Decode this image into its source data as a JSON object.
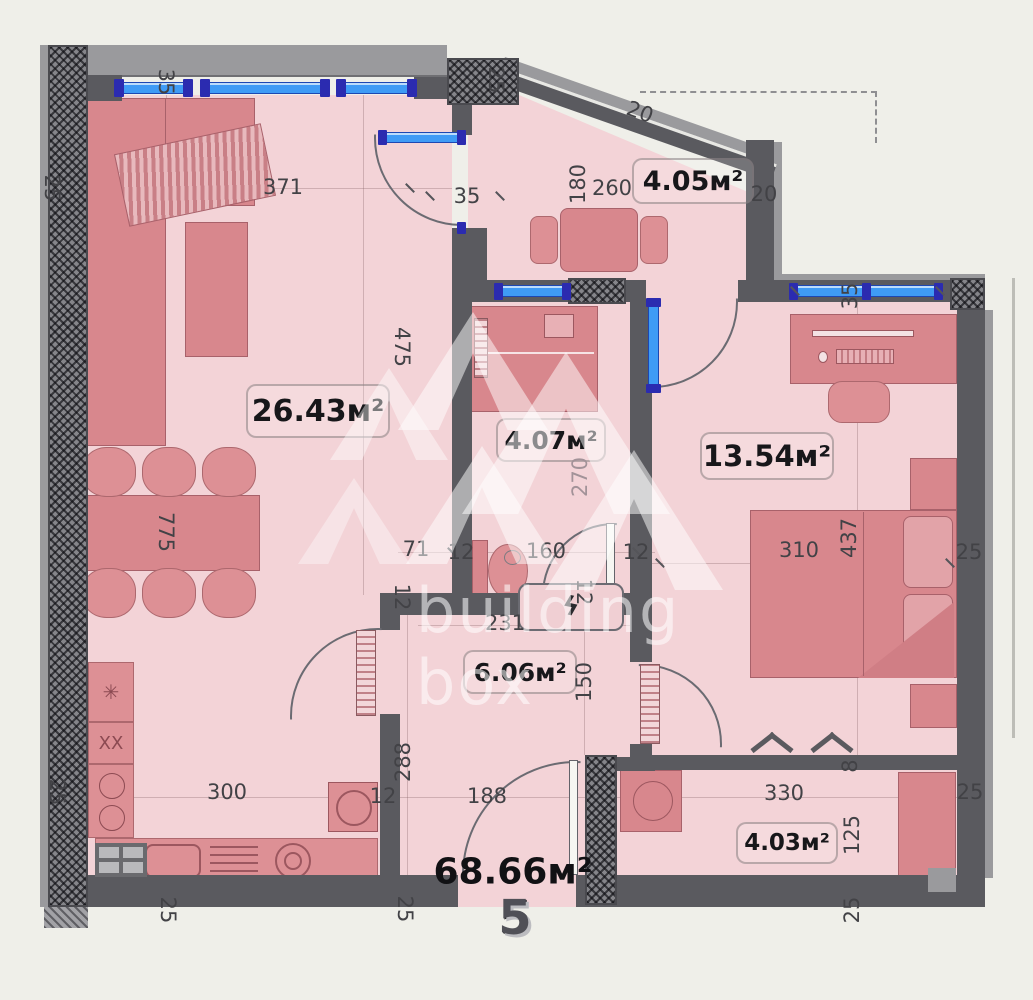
{
  "plan": {
    "apartment_number": "5",
    "total_area": "68.66м²",
    "watermark": {
      "line1": "building",
      "line2": "box",
      "logo": "chevron-pattern"
    },
    "rooms": {
      "living": {
        "area": "26.43м²"
      },
      "bathroom": {
        "area": "4.07м²"
      },
      "bedroom": {
        "area": "13.54м²"
      },
      "hallway": {
        "area": "6.06м²"
      },
      "balcony_top": {
        "area": "4.05м²"
      },
      "balcony_bottom": {
        "area": "4.03м²"
      }
    },
    "colors": {
      "background": "#efefe9",
      "room_fill": "#f3d3d7",
      "furniture": "#dd9095",
      "wall": "#5a5a5f",
      "window_glass": "#3f9bf5",
      "window_frame": "#2b2bb0",
      "watermark": "#ffffff"
    },
    "dimensions": [
      {
        "t": "371",
        "x": 283,
        "y": 187,
        "r": 0
      },
      {
        "t": "35",
        "x": 166,
        "y": 82,
        "r": 90
      },
      {
        "t": "25",
        "x": 52,
        "y": 188,
        "r": 90
      },
      {
        "t": "25",
        "x": 496,
        "y": 80,
        "r": 90
      },
      {
        "t": "35",
        "x": 467,
        "y": 196,
        "r": 0
      },
      {
        "t": "20",
        "x": 640,
        "y": 112,
        "r": 20
      },
      {
        "t": "180",
        "x": 578,
        "y": 184,
        "r": -90
      },
      {
        "t": "260",
        "x": 612,
        "y": 188,
        "r": 0
      },
      {
        "t": "20",
        "x": 764,
        "y": 194,
        "r": 0
      },
      {
        "t": "35",
        "x": 850,
        "y": 296,
        "r": -90
      },
      {
        "t": "475",
        "x": 402,
        "y": 347,
        "r": 90
      },
      {
        "t": "270",
        "x": 580,
        "y": 477,
        "r": -90,
        "c": "muted"
      },
      {
        "t": "71",
        "x": 416,
        "y": 549,
        "r": 0
      },
      {
        "t": "12",
        "x": 461,
        "y": 552,
        "r": 0
      },
      {
        "t": "160",
        "x": 546,
        "y": 551,
        "r": 0
      },
      {
        "t": "12",
        "x": 636,
        "y": 552,
        "r": 0
      },
      {
        "t": "310",
        "x": 799,
        "y": 550,
        "r": 0
      },
      {
        "t": "437",
        "x": 849,
        "y": 538,
        "r": -90
      },
      {
        "t": "25",
        "x": 969,
        "y": 552,
        "r": 0
      },
      {
        "t": "775",
        "x": 166,
        "y": 532,
        "r": 90
      },
      {
        "t": "12",
        "x": 402,
        "y": 597,
        "r": 90
      },
      {
        "t": "12",
        "x": 584,
        "y": 592,
        "r": 90
      },
      {
        "t": "231",
        "x": 505,
        "y": 623,
        "r": 0
      },
      {
        "t": "150",
        "x": 584,
        "y": 682,
        "r": -90
      },
      {
        "t": "288",
        "x": 403,
        "y": 762,
        "r": -90
      },
      {
        "t": "12",
        "x": 383,
        "y": 796,
        "r": 0
      },
      {
        "t": "300",
        "x": 227,
        "y": 792,
        "r": 0
      },
      {
        "t": "188",
        "x": 487,
        "y": 796,
        "r": 0
      },
      {
        "t": "330",
        "x": 784,
        "y": 793,
        "r": 0
      },
      {
        "t": "125",
        "x": 852,
        "y": 835,
        "r": -90
      },
      {
        "t": "25",
        "x": 970,
        "y": 792,
        "r": 0
      },
      {
        "t": "8",
        "x": 850,
        "y": 766,
        "r": -90
      },
      {
        "t": "25",
        "x": 852,
        "y": 910,
        "r": -90
      },
      {
        "t": "25",
        "x": 168,
        "y": 910,
        "r": 90
      },
      {
        "t": "25",
        "x": 405,
        "y": 909,
        "r": 90
      },
      {
        "t": "25",
        "x": 57,
        "y": 792,
        "r": 90
      }
    ]
  }
}
